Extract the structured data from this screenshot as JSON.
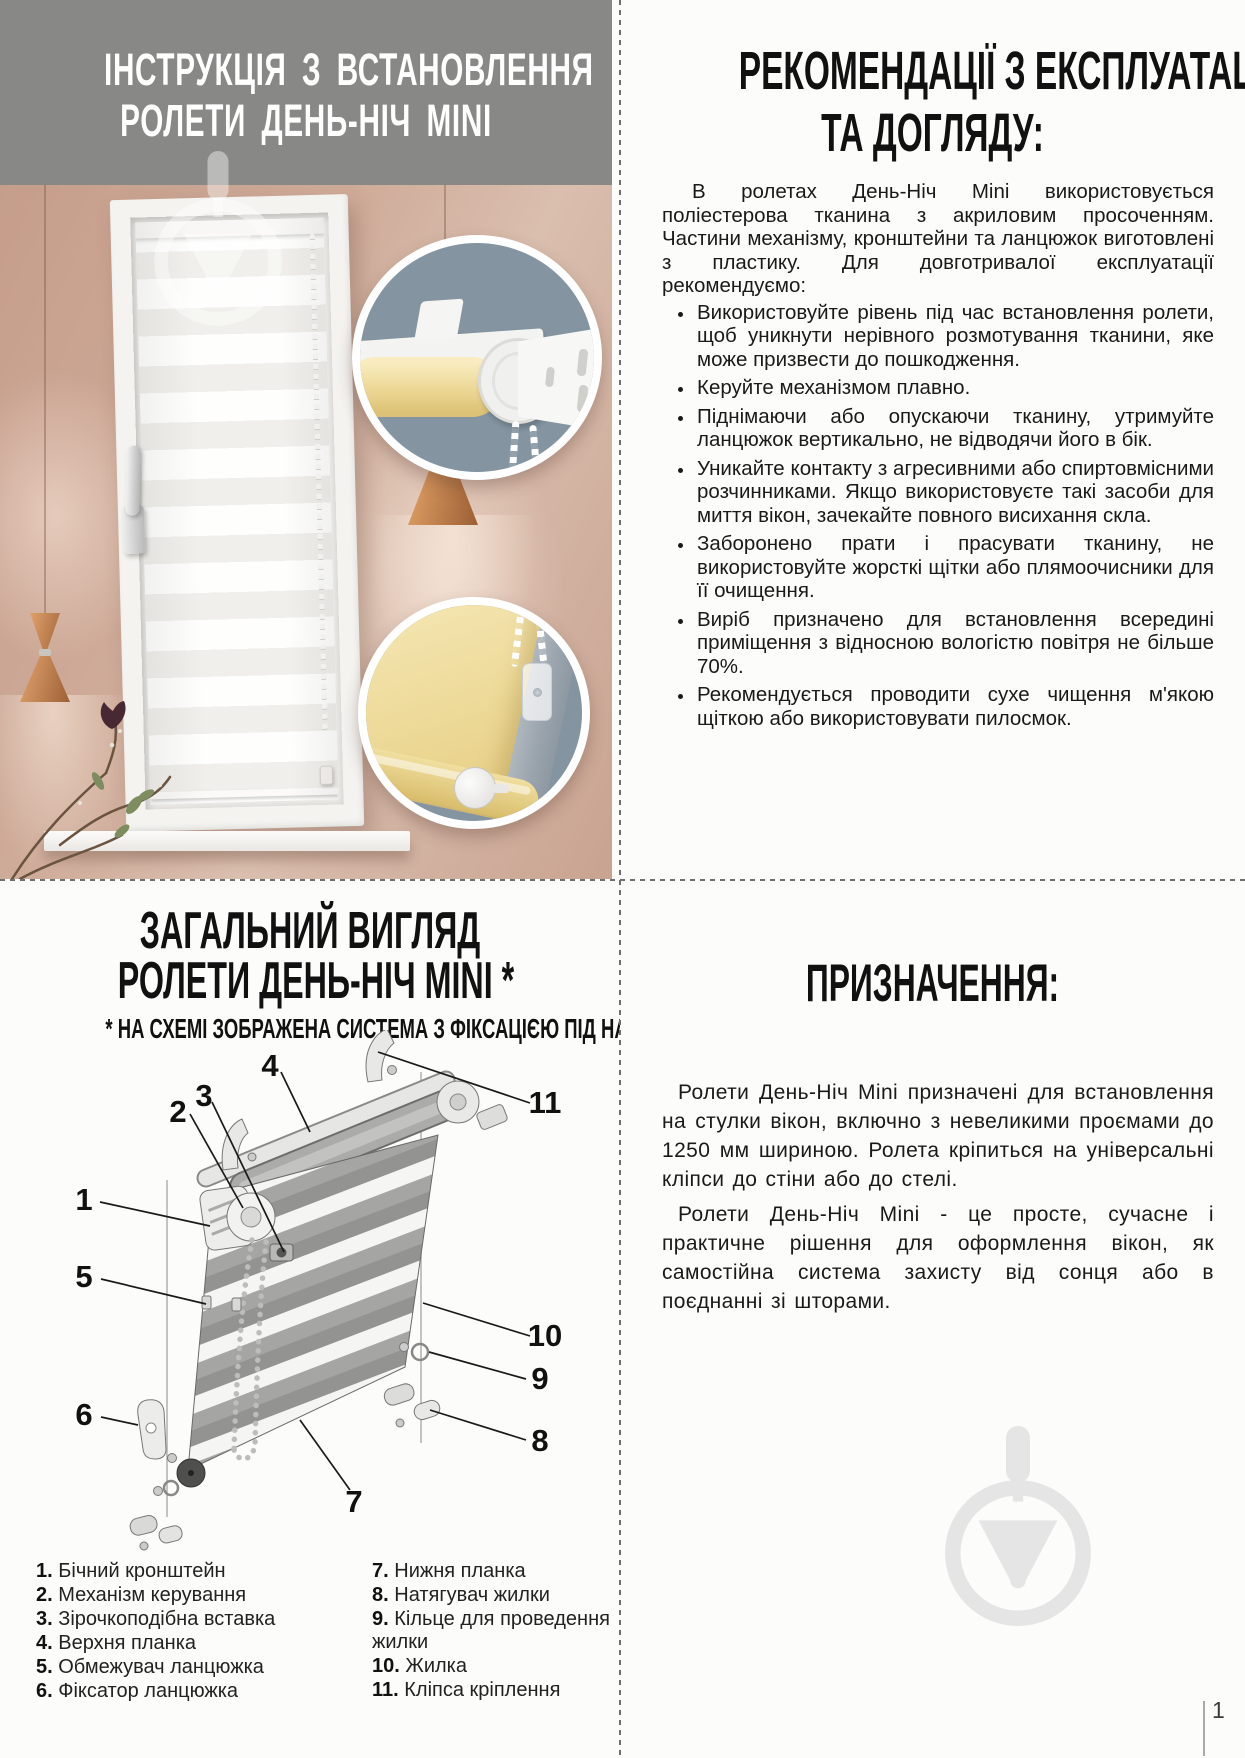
{
  "install": {
    "title_line1": "ІНСТРУКЦІЯ З ВСТАНОВЛЕННЯ",
    "title_line2": "РОЛЕТИ ДЕНЬ-НІЧ MINI"
  },
  "recommendations": {
    "title_line1": "РЕКОМЕНДАЦІЇ З ЕКСПЛУАТАЦІЇ",
    "title_line2": "ТА ДОГЛЯДУ:",
    "intro": "В ролетах День-Ніч Mini використовується поліестерова тканина з акриловим просоченням. Частини механізму, кронштейни та ланцюжок виготовлені з пластику. Для довготривалої експлуатації рекомендуємо:",
    "bullets": [
      "Використовуйте рівень під час встановлення ролети, щоб уникнути нерівного розмотування тканини, яке може призвести до пошкодження.",
      "Керуйте механізмом плавно.",
      "Піднімаючи або опускаючи тканину, утримуйте ланцюжок вертикально, не відводячи його в бік.",
      "Уникайте контакту з агресивними або спиртовмісними розчинниками. Якщо використовуєте такі засоби для миття вікон, зачекайте повного висихання скла.",
      "Заборонено прати і прасувати тканину, не використовуйте жорсткі щітки або плямоочисники для її очищення.",
      "Виріб призначено для встановлення всередині приміщення з відносною вологістю повітря не більше 70%.",
      "Рекомендується проводити сухе чищення м'якою щіткою або використовувати пилосмок."
    ]
  },
  "overview": {
    "title_line1": "ЗАГАЛЬНИЙ ВИГЛЯД",
    "title_line2": "РОЛЕТИ ДЕНЬ-НІЧ MINI *",
    "note": "* НА СХЕМІ ЗОБРАЖЕНА СИСТЕМА З ФІКСАЦІЄЮ ПІД НАХИЛ",
    "callouts": {
      "c1": "1",
      "c2": "2",
      "c3": "3",
      "c4": "4",
      "c5": "5",
      "c6": "6",
      "c7": "7",
      "c8": "8",
      "c9": "9",
      "c10": "10",
      "c11": "11"
    },
    "legend_left": [
      {
        "n": "1.",
        "label": "Бічний кронштейн"
      },
      {
        "n": "2.",
        "label": "Механізм керування"
      },
      {
        "n": "3.",
        "label": "Зірочкоподібна вставка"
      },
      {
        "n": "4.",
        "label": "Верхня планка"
      },
      {
        "n": "5.",
        "label": "Обмежувач ланцюжка"
      },
      {
        "n": "6.",
        "label": "Фіксатор ланцюжка"
      }
    ],
    "legend_right": [
      {
        "n": "7.",
        "label": "Нижня планка"
      },
      {
        "n": "8.",
        "label": "Натягувач жилки"
      },
      {
        "n": "9.",
        "label": "Кільце для проведення жилки"
      },
      {
        "n": "10.",
        "label": "Жилка"
      },
      {
        "n": "11.",
        "label": "Кліпса кріплення"
      }
    ]
  },
  "purpose": {
    "title": "ПРИЗНАЧЕННЯ:",
    "p1": "Ролети День-Ніч Mini призначені для встановлення на стулки вікон, включно з невеликими проємами до 1250 мм шириною. Ролета кріпиться на універсальні кліпси до стіни або до стелі.",
    "p2": "Ролети День-Ніч Mini - це просте, сучасне і практичне рішення для оформлення вікон, як самостійна система захисту від сонця або в поєднанні зі шторами."
  },
  "footer": {
    "page_number": "1"
  },
  "icons": {
    "watermark": "trowel-circle-logo"
  },
  "colors": {
    "header_gray": "#888887",
    "wall_pink": "#cfab99",
    "fabric_yellow": "#ecd794",
    "inset_blue_gray": "#8494a1",
    "copper": "#b5744a",
    "watermark_gray": "#e5e5e5",
    "text": "#1a1a1a"
  }
}
